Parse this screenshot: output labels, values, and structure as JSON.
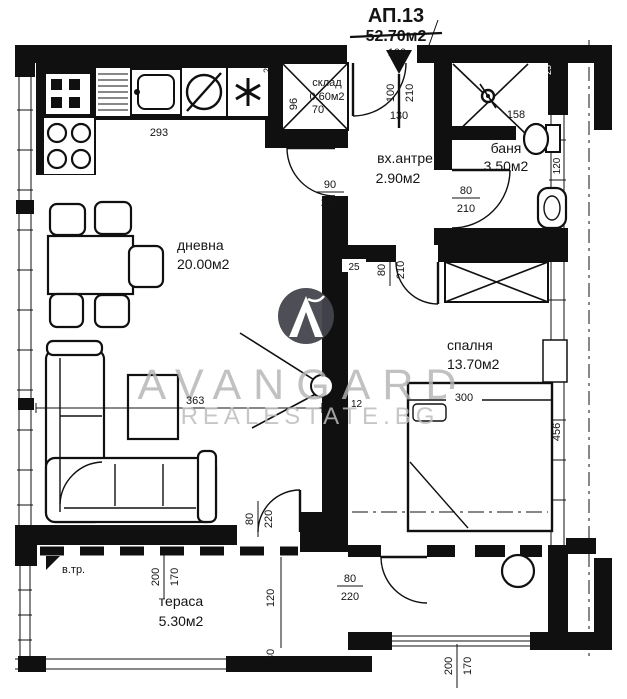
{
  "title": {
    "apartment": "АП.13",
    "total_area": "52.70м2",
    "entry_width": "100"
  },
  "watermark": {
    "brand": "AVANGARD",
    "domain": "REALESTATE.BG",
    "logo_letter": "A",
    "circle_color": "#45454d",
    "text_color": "#b4b4b4"
  },
  "rooms": {
    "living": {
      "name": "дневна",
      "area": "20.00м2"
    },
    "storage": {
      "name": "склад",
      "area": "0.60м2"
    },
    "hall": {
      "name": "вх.антре",
      "area": "2.90м2"
    },
    "bath": {
      "name": "баня",
      "area": "3.50м2"
    },
    "bedroom": {
      "name": "спалня",
      "area": "13.70м2"
    },
    "terrace": {
      "name": "тераса",
      "area": "5.30м2"
    }
  },
  "labels": {
    "vertical_shaft": "в.тр."
  },
  "dims": {
    "entry_door": {
      "num": "100",
      "den": "210"
    },
    "entry_offset": "130",
    "kitchen_counter": "293",
    "sofa_wall": "363",
    "storage_width": "70",
    "storage_depth": "96",
    "storage_wall": "25",
    "living_door": {
      "num": "90",
      "den": "210"
    },
    "bath_door": {
      "num": "80",
      "den": "210"
    },
    "shower": "158",
    "bath_fixture": "120",
    "bath_wall": "25",
    "bedroom_door": {
      "num": "80",
      "den": "210"
    },
    "bedroom_wall": "25",
    "bed_width": "300",
    "bed_length": "456",
    "wall_12": "12",
    "terrace_door_living": {
      "num": "80",
      "den": "220"
    },
    "terrace_door_bedroom": {
      "num": "80",
      "den": "220"
    },
    "terrace_window": {
      "num": "200",
      "den": "170"
    },
    "bedroom_window": {
      "num": "200",
      "den": "170"
    },
    "terrace_120": "120",
    "terrace_30": "30"
  }
}
